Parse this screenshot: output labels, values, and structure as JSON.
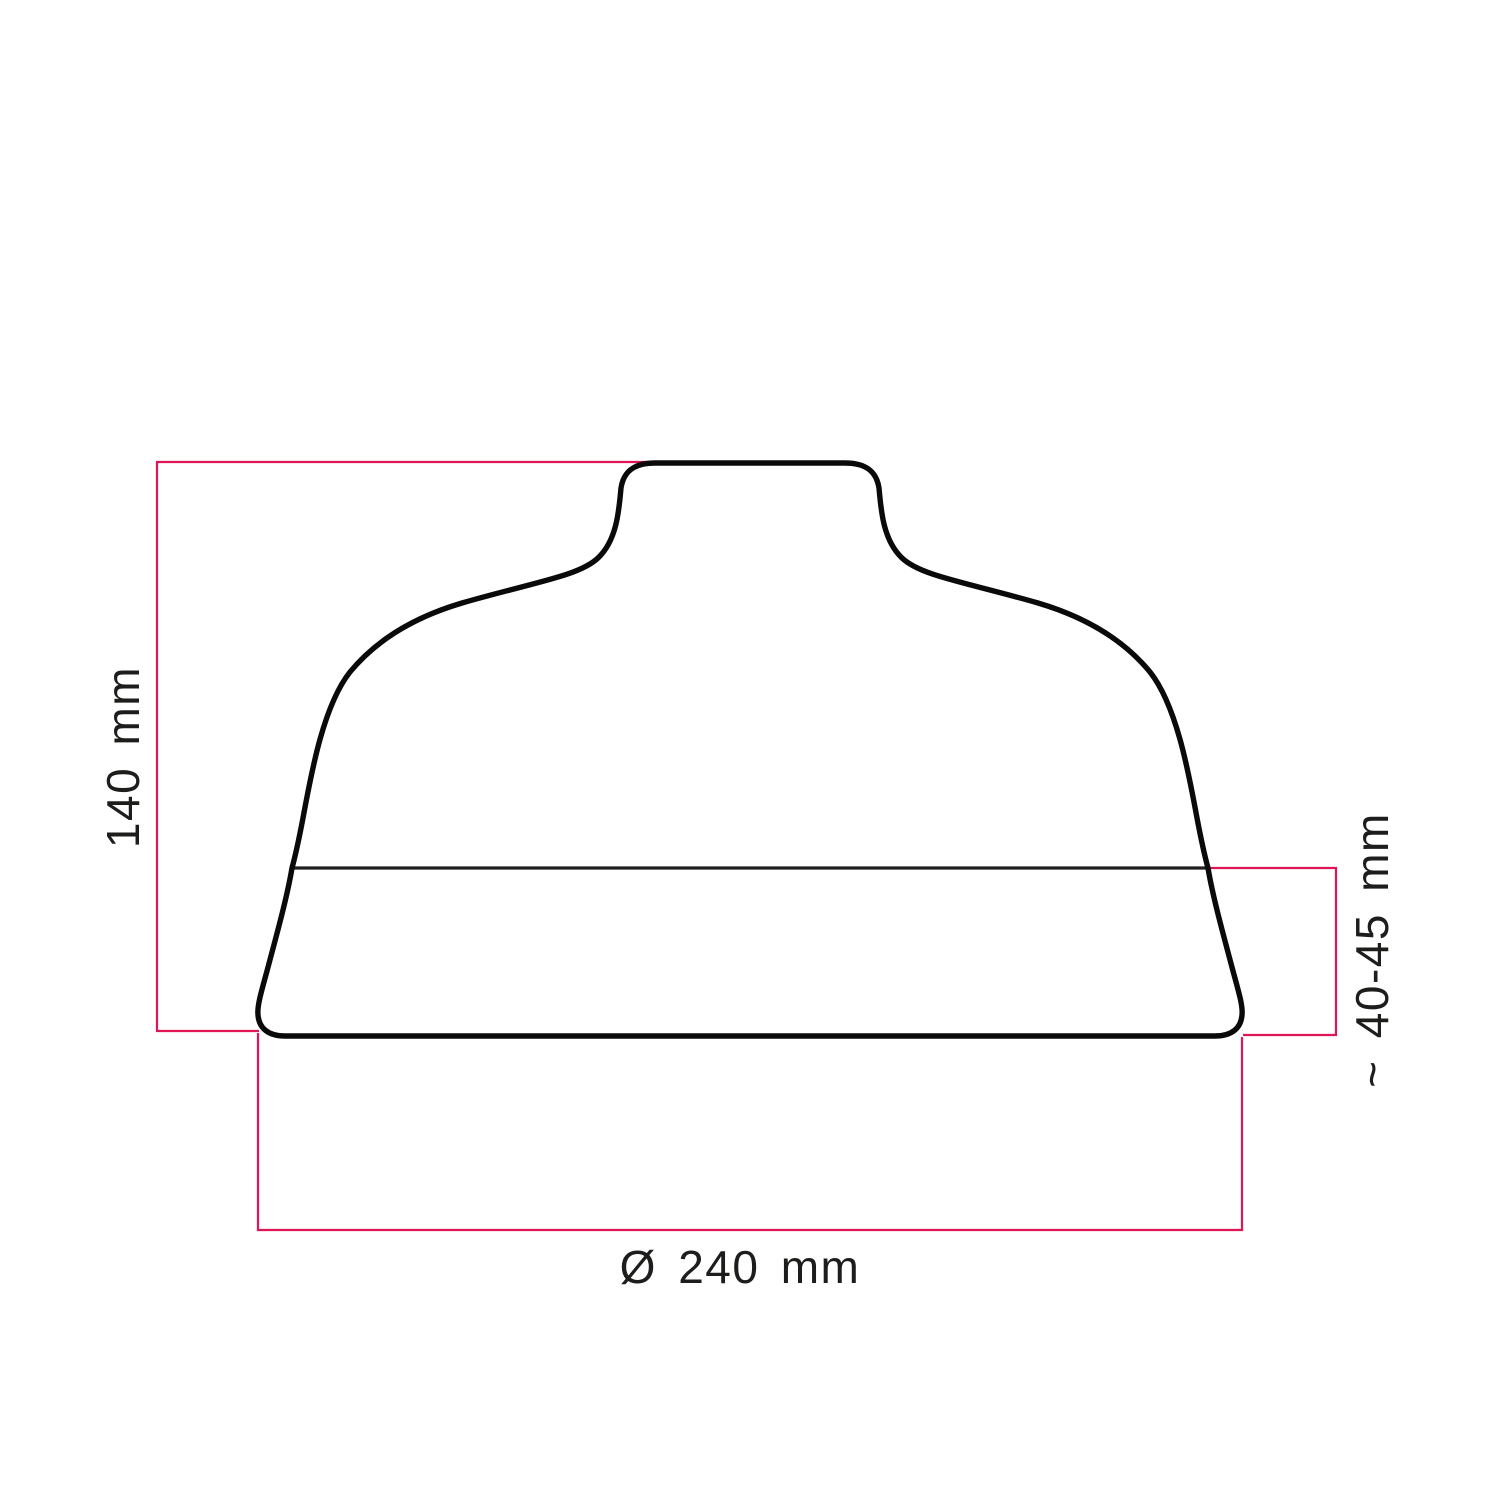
{
  "diagram": {
    "type": "technical-dimension-drawing",
    "subject": "lampshade-silhouette",
    "labels": {
      "height": "140 mm",
      "socket_depth": "~ 40-45 mm",
      "diameter": "Ø 240 mm"
    },
    "dimensions": {
      "height_mm": 140,
      "socket_depth_mm": "40-45",
      "diameter_mm": 240
    },
    "colors": {
      "dimension_line": "#df1556",
      "outline": "#0a0a0a",
      "seam": "#1e1e1e",
      "text": "#1d1d1b",
      "background": "#ffffff"
    }
  }
}
